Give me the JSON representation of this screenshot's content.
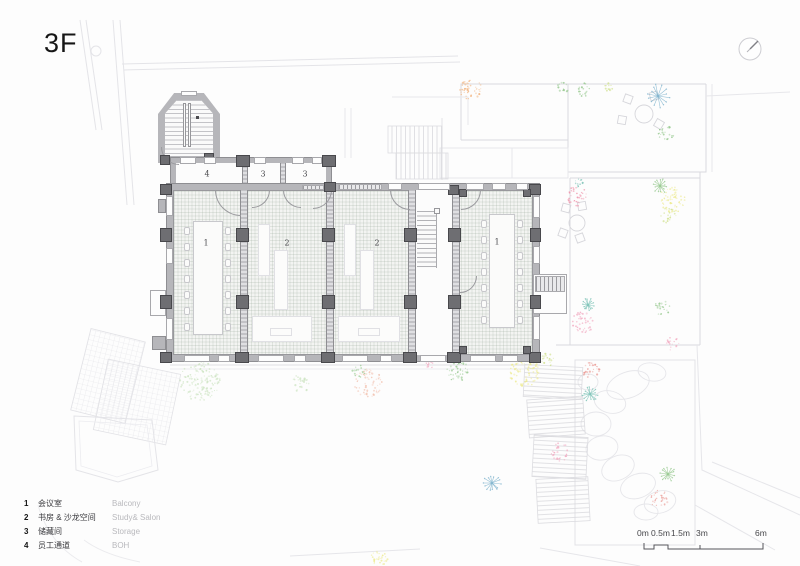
{
  "title": "3F",
  "plan": {
    "room_labels": {
      "room1_left": "1",
      "room2_a": "2",
      "room2_b": "2",
      "room1_right": "1",
      "room4": "4",
      "room3_a": "3",
      "room3_b": "3"
    }
  },
  "legend": {
    "items": [
      {
        "num": "1",
        "zh": "会议室",
        "en": "Balcony"
      },
      {
        "num": "2",
        "zh": "书房 & 沙龙空间",
        "en": "Study& Salon"
      },
      {
        "num": "3",
        "zh": "储藏间",
        "en": "Storage"
      },
      {
        "num": "4",
        "zh": "员工通道",
        "en": "BOH"
      }
    ]
  },
  "scale_bar": {
    "labels": [
      "0m",
      "0.5m",
      "1.5m",
      "3m",
      "6m"
    ]
  },
  "palette": {
    "wall": "#b6b6ba",
    "column": "#6e6e72",
    "line": "#9a9a9e",
    "faint": "#e3e3e8",
    "plant_green": "#93c78b",
    "plant_palegreen": "#cde4c2",
    "plant_lime": "#cfe08a",
    "plant_yellow": "#ece98a",
    "plant_orange": "#f2b27c",
    "plant_rose": "#ef8fa8",
    "plant_pink": "#f2a8c0",
    "plant_red": "#ea9a94",
    "plant_salmon": "#f2c0ae",
    "plant_blue": "#7ab1cc",
    "plant_teal": "#77c0b4"
  }
}
